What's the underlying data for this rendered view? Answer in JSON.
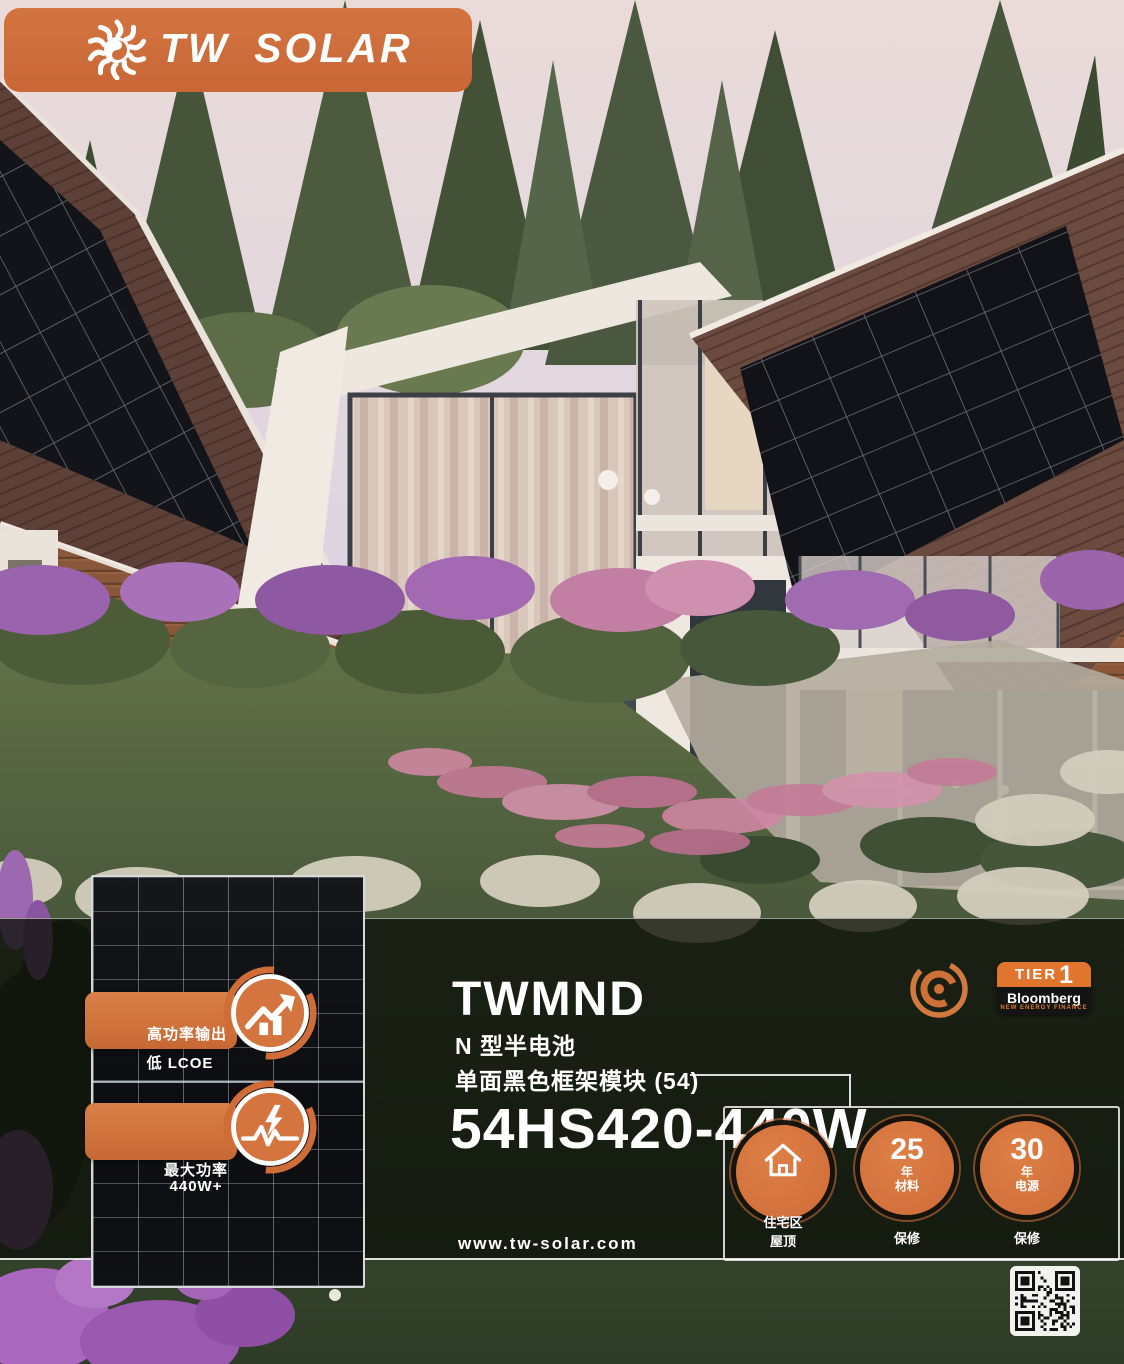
{
  "brand": {
    "logo_text": "TW SOLAR",
    "accent_orange": "#cf6c38",
    "badge_orange": "#d4743e",
    "tier_orange": "#e2752e"
  },
  "product": {
    "series": "TWMND",
    "type_line": "N 型半电池",
    "desc_line": "单面黑色框架模块 (54)",
    "model": "54HS420-440W"
  },
  "panel_callouts": [
    {
      "icon": "growth-chart-icon",
      "title": "高功率输出",
      "subtitle": "低 LCOE"
    },
    {
      "icon": "power-pulse-icon",
      "title": "最大功率",
      "subtitle": "440W+"
    }
  ],
  "certifications": {
    "swirl_icon": "certification-swirl-logo",
    "tier_label": "TIER",
    "tier_number": "1",
    "tier_brand": "Bloomberg",
    "tier_sub": "NEW ENERGY FINANCE"
  },
  "feature_circles": [
    {
      "icon": "house-icon",
      "inner_label": "住宅区",
      "below_label": "屋顶"
    },
    {
      "value": "25",
      "unit": "年",
      "category": "材料",
      "below_label": "保修"
    },
    {
      "value": "30",
      "unit": "年",
      "category": "电源",
      "below_label": "保修"
    }
  ],
  "footer": {
    "website": "www.tw-solar.com",
    "qr_label": "qr-code"
  }
}
